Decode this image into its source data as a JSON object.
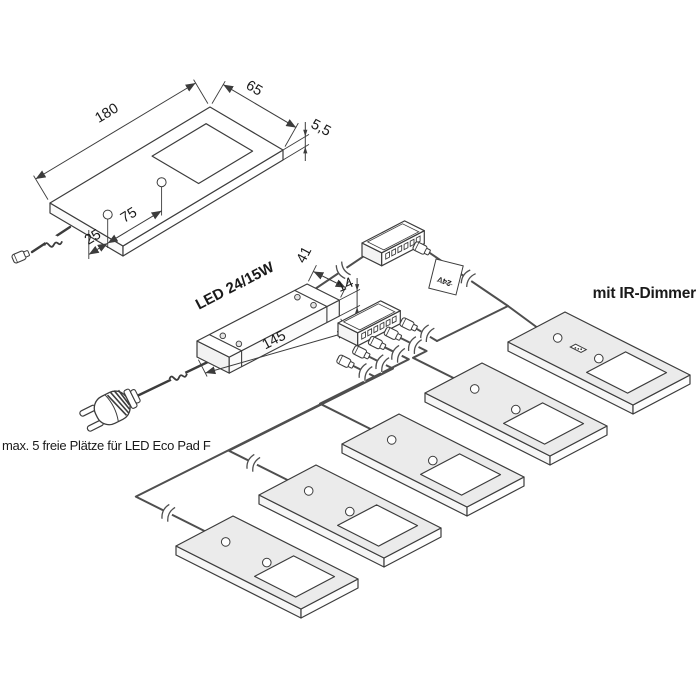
{
  "panel_detail": {
    "length": "180",
    "width": "65",
    "thickness": "5,5",
    "hole_edge_offset": "25",
    "hole_spacing": "75"
  },
  "power_supply": {
    "label": "LED 24/15W",
    "length": "145",
    "width": "41",
    "height": "14"
  },
  "tag": {
    "label": "24V"
  },
  "notes": {
    "ir_dimmer": "mit IR-Dimmer",
    "capacity": "max. 5 freie Plätze für LED Eco Pad F"
  }
}
